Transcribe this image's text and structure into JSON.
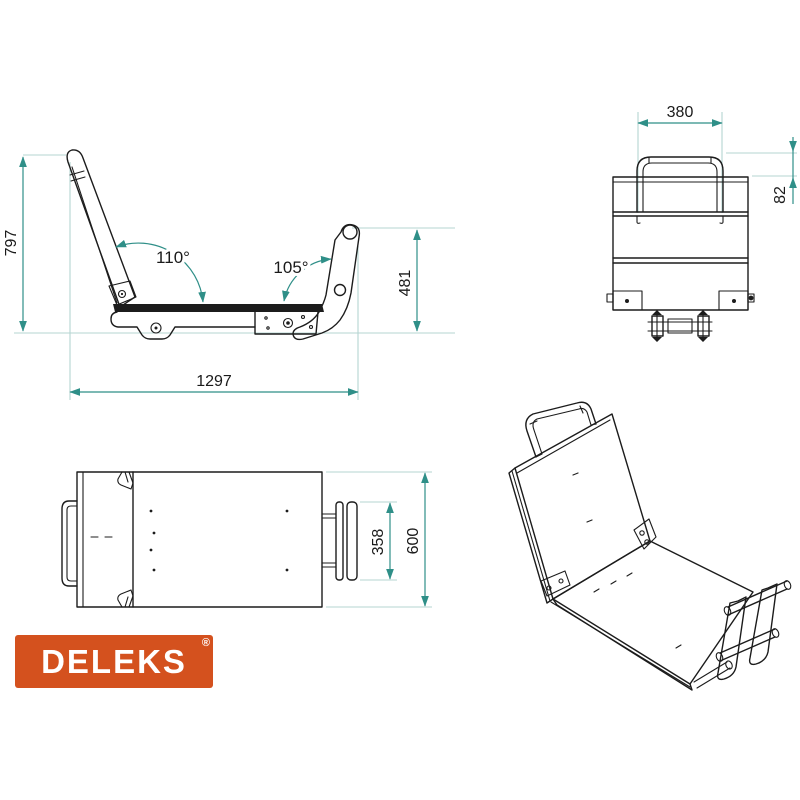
{
  "drawing": {
    "side_view": {
      "overall_height": "797",
      "overall_length": "1297",
      "arm_height": "481",
      "backrest_angle": "110°",
      "arm_angle": "105°"
    },
    "rear_view": {
      "handle_width": "380",
      "handle_height": "82"
    },
    "top_view": {
      "frame_width": "358",
      "overall_depth": "600"
    }
  },
  "logo": {
    "brand": "DELEKS",
    "registered_mark": "®"
  },
  "colors": {
    "background": "#ffffff",
    "part_line": "#1c1c1c",
    "dimension_line": "#2f8f88",
    "extension_line": "#b5d4d2",
    "logo_background": "#d4511e",
    "logo_text": "#ffffff"
  }
}
